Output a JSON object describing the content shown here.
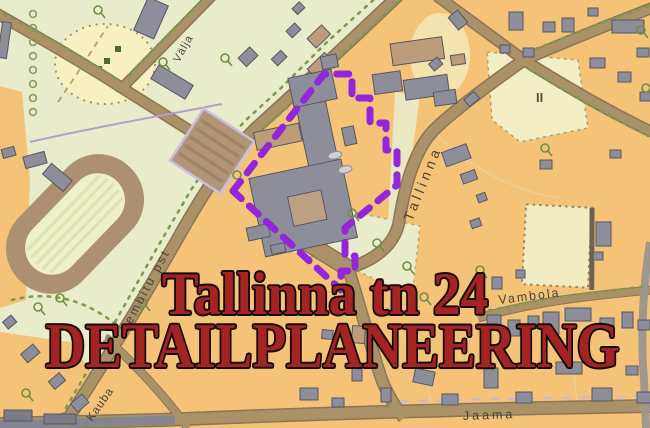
{
  "title": {
    "line1": "Tallinna tn 24",
    "line2": "DETAILPLANEERING",
    "text_color": "#a32420",
    "outline_color": "#150a0a"
  },
  "map": {
    "street_labels": {
      "valja": "Välja",
      "tallinna": "Tallinna",
      "lembitu": "Lembitu pst",
      "vambola": "Vambola",
      "kauba": "Kauba",
      "jaama": "Jaama"
    },
    "area_marker": "II",
    "planning_boundary_color": "#9326d9",
    "colors": {
      "park_green": "#e9ecca",
      "parcel_orange": "#f4c377",
      "field_yellow": "#f3edc5",
      "road_brown": "#ab9168",
      "road_casing": "#8a7556",
      "building_gray": "#8e8e9a",
      "building_brown": "#bd9c7c",
      "tree_green": "#6f8f3f"
    }
  }
}
